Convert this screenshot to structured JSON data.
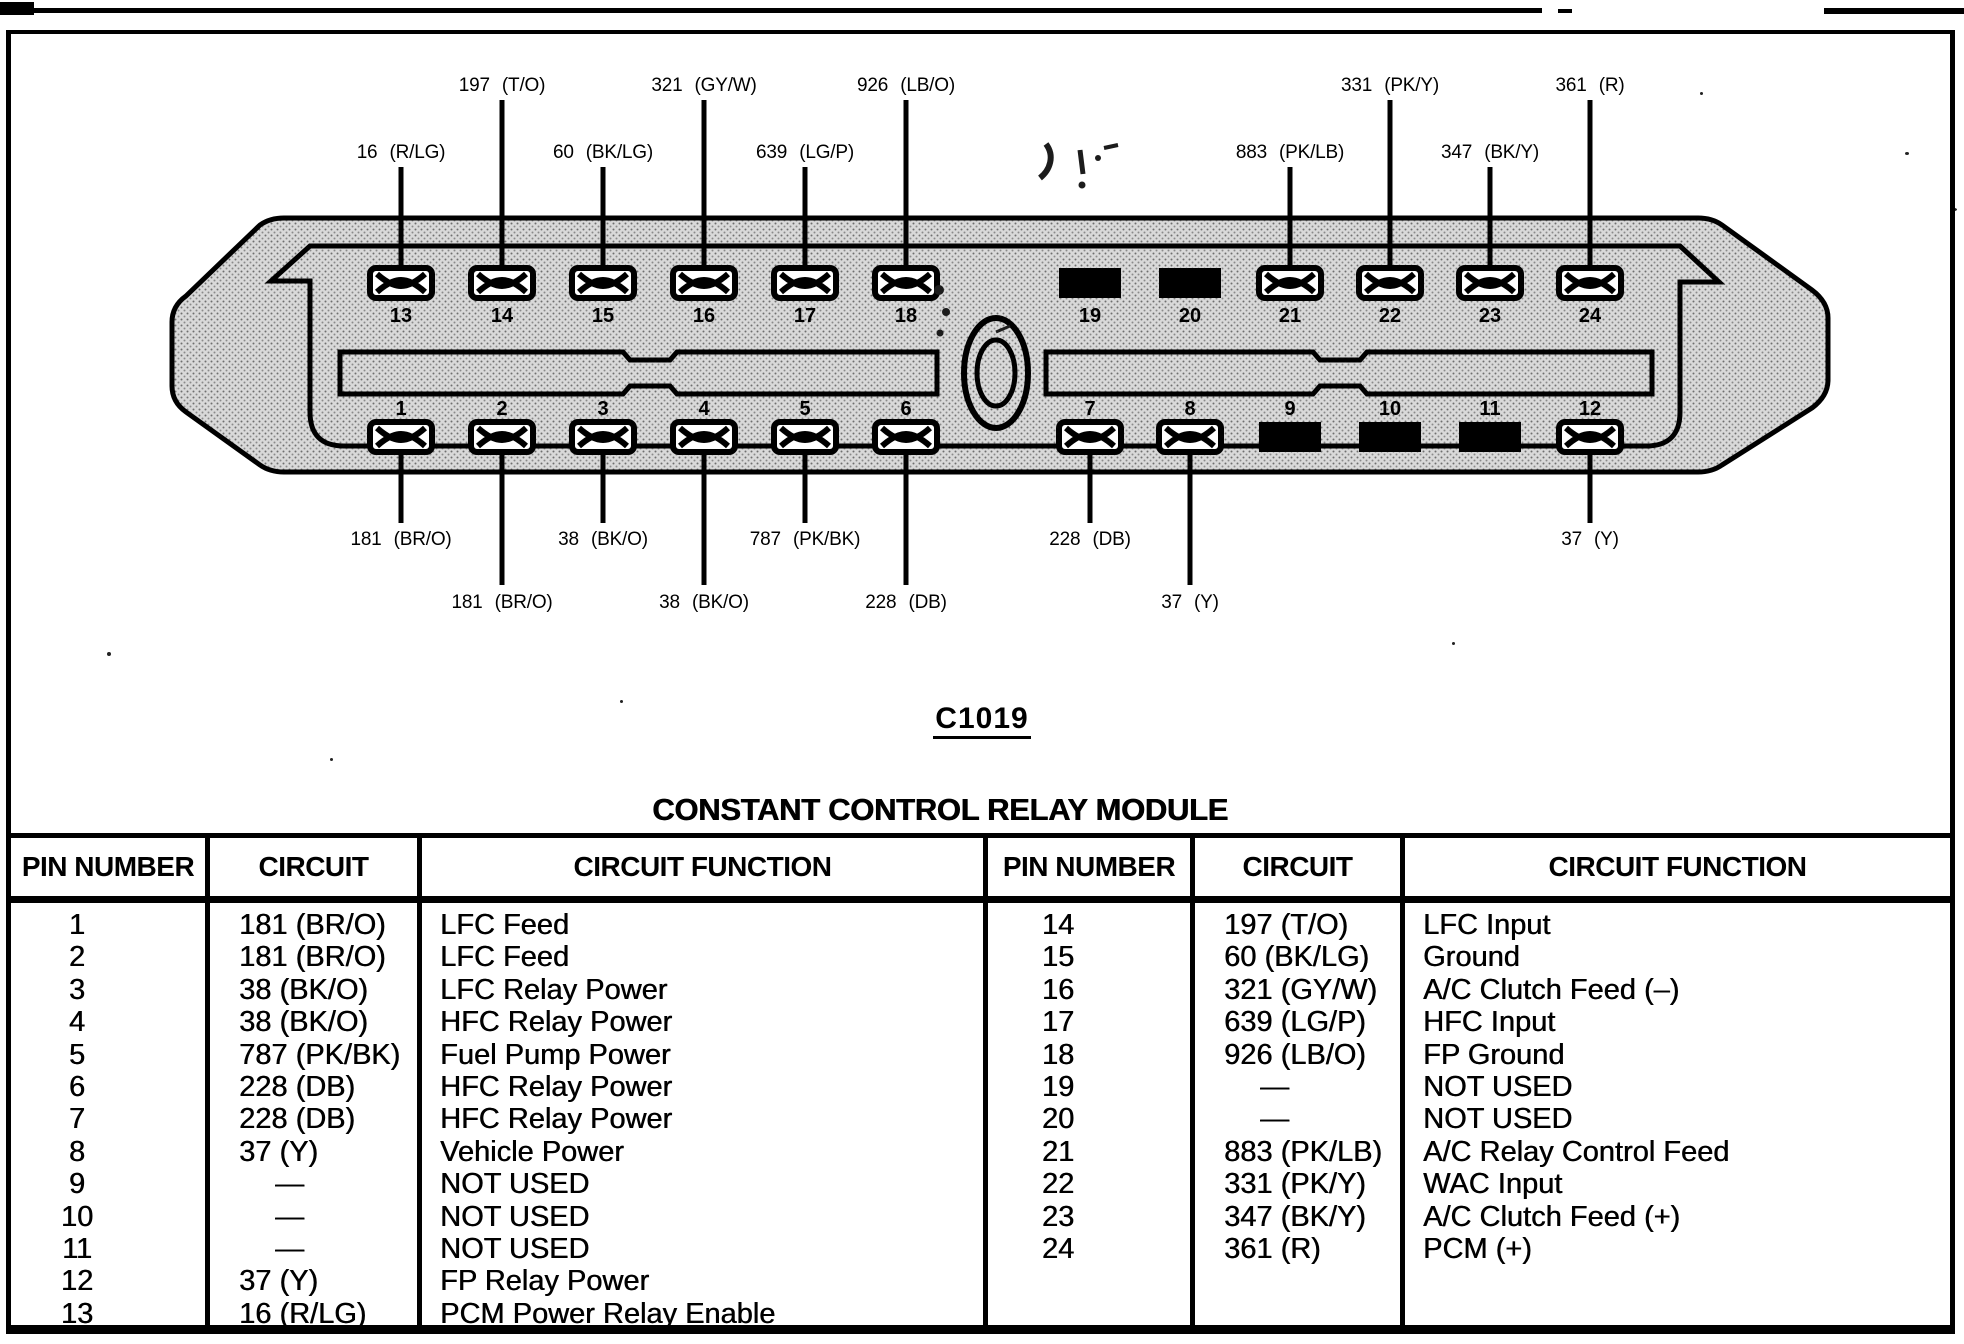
{
  "title": {
    "connector_id": "C1019",
    "connector_name": "CONSTANT CONTROL RELAY MODULE"
  },
  "connector": {
    "pin_numbers_top": [
      "13",
      "14",
      "15",
      "16",
      "17",
      "18",
      "19",
      "20",
      "21",
      "22",
      "23",
      "24"
    ],
    "pin_numbers_bottom": [
      "1",
      "2",
      "3",
      "4",
      "5",
      "6",
      "7",
      "8",
      "9",
      "10",
      "11",
      "12"
    ],
    "wire_labels_top_row1": [
      "197 (T/O)",
      "321 (GY/W)",
      "926 (LB/O)",
      "331 (PK/Y)",
      "361 (R)"
    ],
    "wire_labels_top_row2": [
      "16 (R/LG)",
      "60 (BK/LG)",
      "639 (LG/P)",
      "883 (PK/LB)",
      "347 (BK/Y)"
    ],
    "wire_labels_bottom_row1": [
      "181 (BR/O)",
      "38 (BK/O)",
      "787 (PK/BK)",
      "228 (DB)",
      "37 (Y)"
    ],
    "wire_labels_bottom_row2": [
      "181 (BR/O)",
      "38 (BK/O)",
      "228 (DB)",
      "37 (Y)"
    ]
  },
  "table": {
    "headers": [
      "PIN NUMBER",
      "CIRCUIT",
      "CIRCUIT FUNCTION"
    ],
    "left_rows": [
      [
        "1",
        "181 (BR/O)",
        "LFC Feed"
      ],
      [
        "2",
        "181 (BR/O)",
        "LFC Feed"
      ],
      [
        "3",
        "38 (BK/O)",
        "LFC Relay Power"
      ],
      [
        "4",
        "38 (BK/O)",
        "HFC Relay Power"
      ],
      [
        "5",
        "787 (PK/BK)",
        "Fuel Pump Power"
      ],
      [
        "6",
        "228 (DB)",
        "HFC Relay Power"
      ],
      [
        "7",
        "228 (DB)",
        "HFC Relay Power"
      ],
      [
        "8",
        "37 (Y)",
        "Vehicle Power"
      ],
      [
        "9",
        "—",
        "NOT USED"
      ],
      [
        "10",
        "—",
        "NOT USED"
      ],
      [
        "11",
        "—",
        "NOT USED"
      ],
      [
        "12",
        "37 (Y)",
        "FP Relay Power"
      ],
      [
        "13",
        "16 (R/LG)",
        "PCM Power Relay Enable"
      ]
    ],
    "right_rows": [
      [
        "14",
        "197 (T/O)",
        "LFC Input"
      ],
      [
        "15",
        "60 (BK/LG)",
        "Ground"
      ],
      [
        "16",
        "321 (GY/W)",
        "A/C Clutch Feed (–)"
      ],
      [
        "17",
        "639 (LG/P)",
        "HFC Input"
      ],
      [
        "18",
        "926 (LB/O)",
        "FP Ground"
      ],
      [
        "19",
        "—",
        "NOT USED"
      ],
      [
        "20",
        "—",
        "NOT USED"
      ],
      [
        "21",
        "883 (PK/LB)",
        "A/C Relay Control Feed"
      ],
      [
        "22",
        "331 (PK/Y)",
        "WAC Input"
      ],
      [
        "23",
        "347 (BK/Y)",
        "A/C Clutch Feed (+)"
      ],
      [
        "24",
        "361 (R)",
        "PCM (+)"
      ]
    ]
  }
}
